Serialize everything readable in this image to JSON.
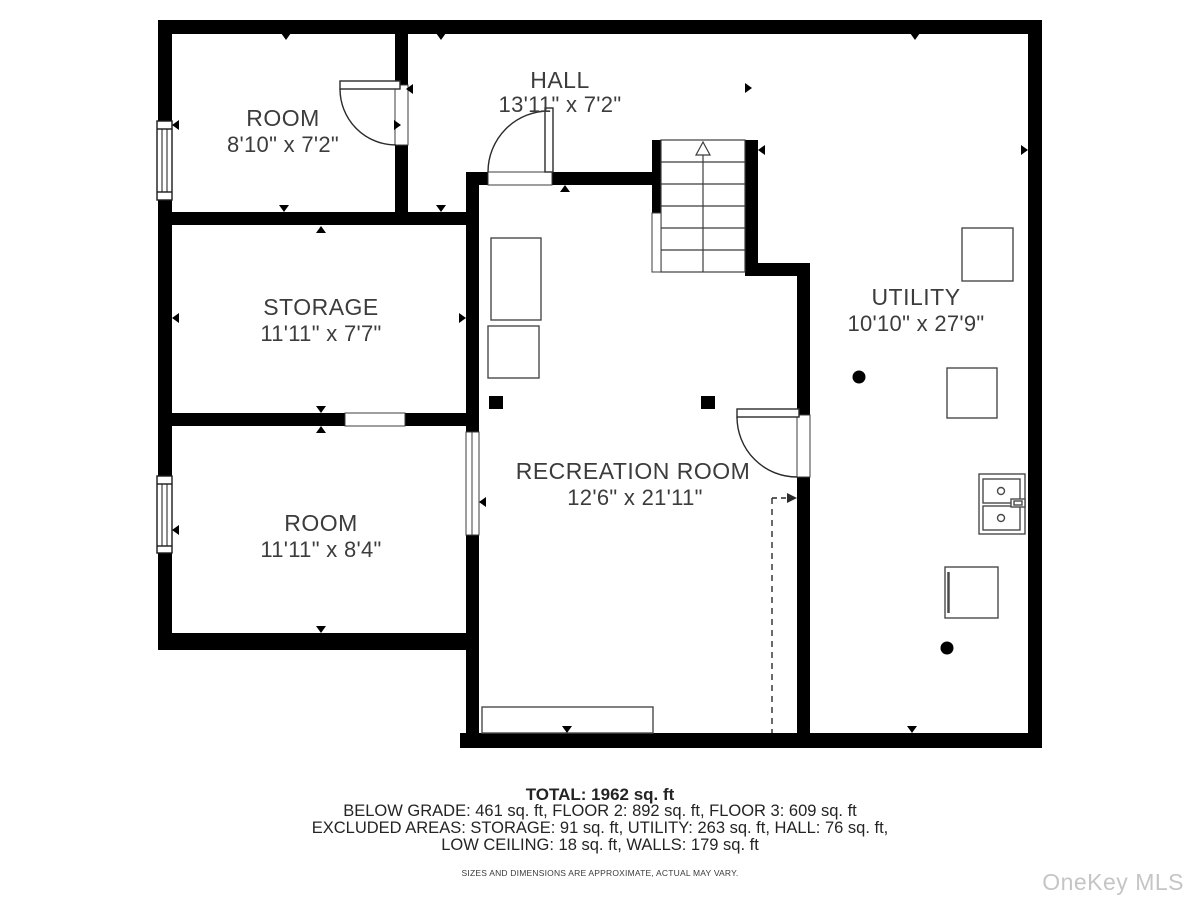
{
  "colors": {
    "wall": "#000000",
    "label_text": "#3c3c3c",
    "footer_text": "#242424",
    "watermark_text": "#c5c5c5",
    "background": "#ffffff"
  },
  "rooms": [
    {
      "name": "ROOM",
      "dims": "8'10\" x 7'2\""
    },
    {
      "name": "HALL",
      "dims": "13'11\" x 7'2\""
    },
    {
      "name": "STORAGE",
      "dims": "11'11\" x 7'7\""
    },
    {
      "name": "ROOM",
      "dims": "11'11\" x 8'4\""
    },
    {
      "name": "RECREATION ROOM",
      "dims": "12'6\" x 21'11\""
    },
    {
      "name": "UTILITY",
      "dims": "10'10\" x 27'9\""
    }
  ],
  "footer": {
    "total": "TOTAL: 1962 sq. ft",
    "floors": "BELOW GRADE: 461 sq. ft, FLOOR 2: 892 sq. ft, FLOOR 3: 609 sq. ft",
    "excluded": "EXCLUDED AREAS: STORAGE: 91 sq. ft, UTILITY: 263 sq. ft, HALL: 76 sq. ft,",
    "excluded2": "LOW CEILING: 18 sq. ft, WALLS: 179 sq. ft",
    "disclaimer": "SIZES AND DIMENSIONS ARE APPROXIMATE, ACTUAL MAY VARY."
  },
  "watermark": "OneKey MLS"
}
